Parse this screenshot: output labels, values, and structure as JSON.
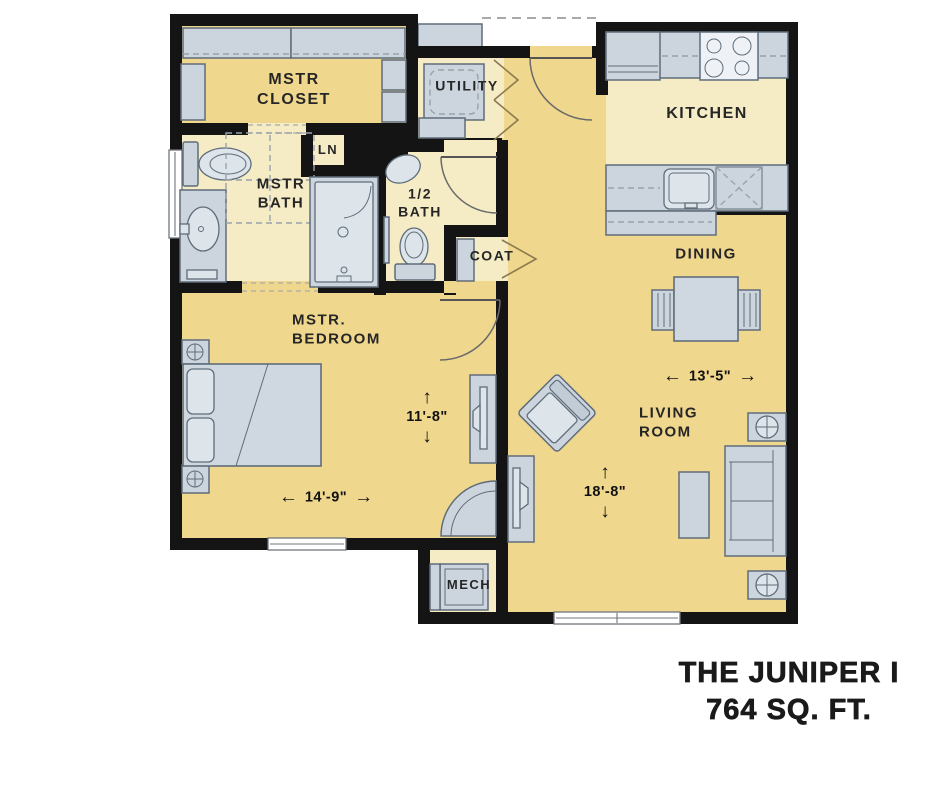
{
  "title": {
    "line1": "THE JUNIPER I",
    "line2": "764 SQ. FT."
  },
  "rooms": {
    "mstr_closet": {
      "label": "MSTR\nCLOSET"
    },
    "utility": {
      "label": "UTILITY"
    },
    "kitchen": {
      "label": "KITCHEN"
    },
    "mstr_bath": {
      "label": "MSTR\nBATH"
    },
    "linen": {
      "label": "LN"
    },
    "half_bath": {
      "label": "1/2\nBATH"
    },
    "coat": {
      "label": "COAT"
    },
    "dining": {
      "label": "DINING"
    },
    "mstr_bedroom": {
      "label": "MSTR.\nBEDROOM"
    },
    "living_room": {
      "label": "LIVING\nROOM"
    },
    "mech": {
      "label": "MECH"
    }
  },
  "dimensions": {
    "bedroom_depth": {
      "text": "11'-8\"",
      "orientation": "vertical"
    },
    "bedroom_width": {
      "text": "14'-9\"",
      "orientation": "horizontal"
    },
    "living_width": {
      "text": "13'-5\"",
      "orientation": "horizontal"
    },
    "living_depth": {
      "text": "18'-8\"",
      "orientation": "vertical"
    }
  },
  "icons": {
    "arrow_up": "↑",
    "arrow_down": "↓",
    "arrow_left": "←",
    "arrow_right": "→"
  },
  "colors": {
    "floor_main": "#f0d78e",
    "floor_light": "#f5ecc6",
    "wall": "#141414",
    "furniture_fill": "#ccd5de",
    "furniture_fill_light": "#dde4ea",
    "furniture_outline": "#5f6d7a",
    "label_text": "#262626",
    "dash_line": "#9aa2ab"
  }
}
